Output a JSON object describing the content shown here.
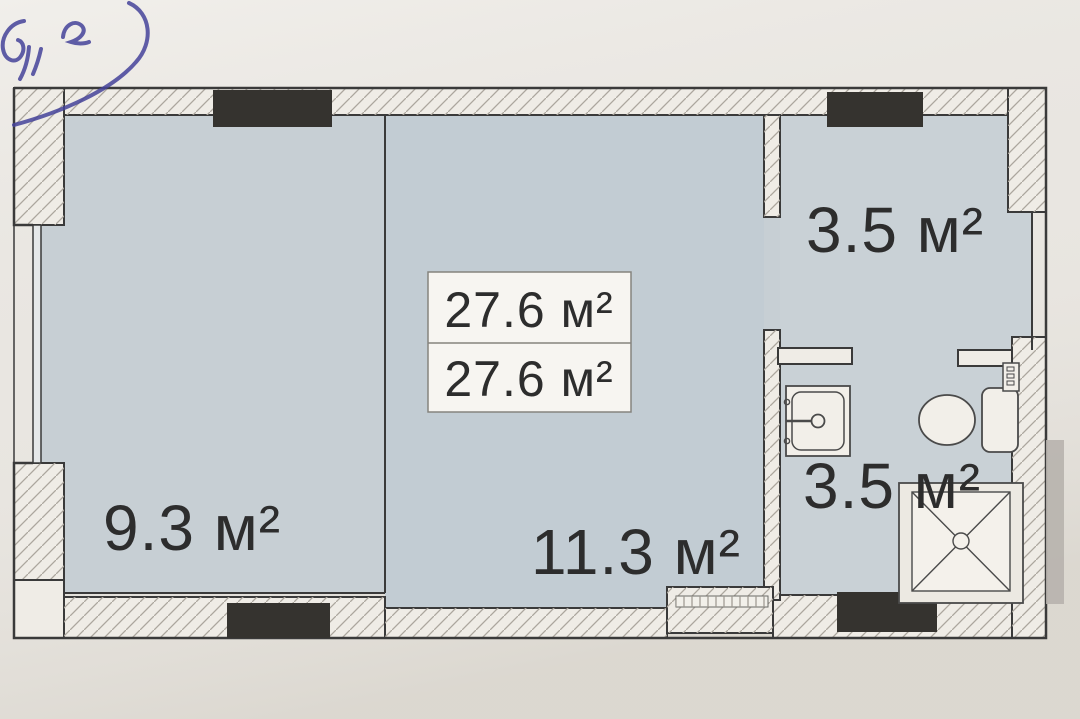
{
  "floor_plan": {
    "area_summary_box": {
      "line1": "27.6 м²",
      "line2": "27.6 м²"
    },
    "rooms": [
      {
        "key": "balcony",
        "area_label": "9.3 м²"
      },
      {
        "key": "living_area",
        "area_label": "11.3 м²"
      },
      {
        "key": "entry_hall",
        "area_label": "3.5 м²"
      },
      {
        "key": "bathroom",
        "area_label": "3.5 м²"
      }
    ],
    "fixtures": [
      {
        "icon": "sink-icon"
      },
      {
        "icon": "toilet-icon"
      },
      {
        "icon": "shower-tray-icon"
      },
      {
        "icon": "vent-shaft-icon"
      }
    ],
    "colors": {
      "floor_fill": "#c6ced5",
      "paper": "#e9e6e1",
      "wall_line": "#3a3a3a",
      "window_block": "#35332f",
      "handwriting_ink": "#45439a"
    }
  }
}
